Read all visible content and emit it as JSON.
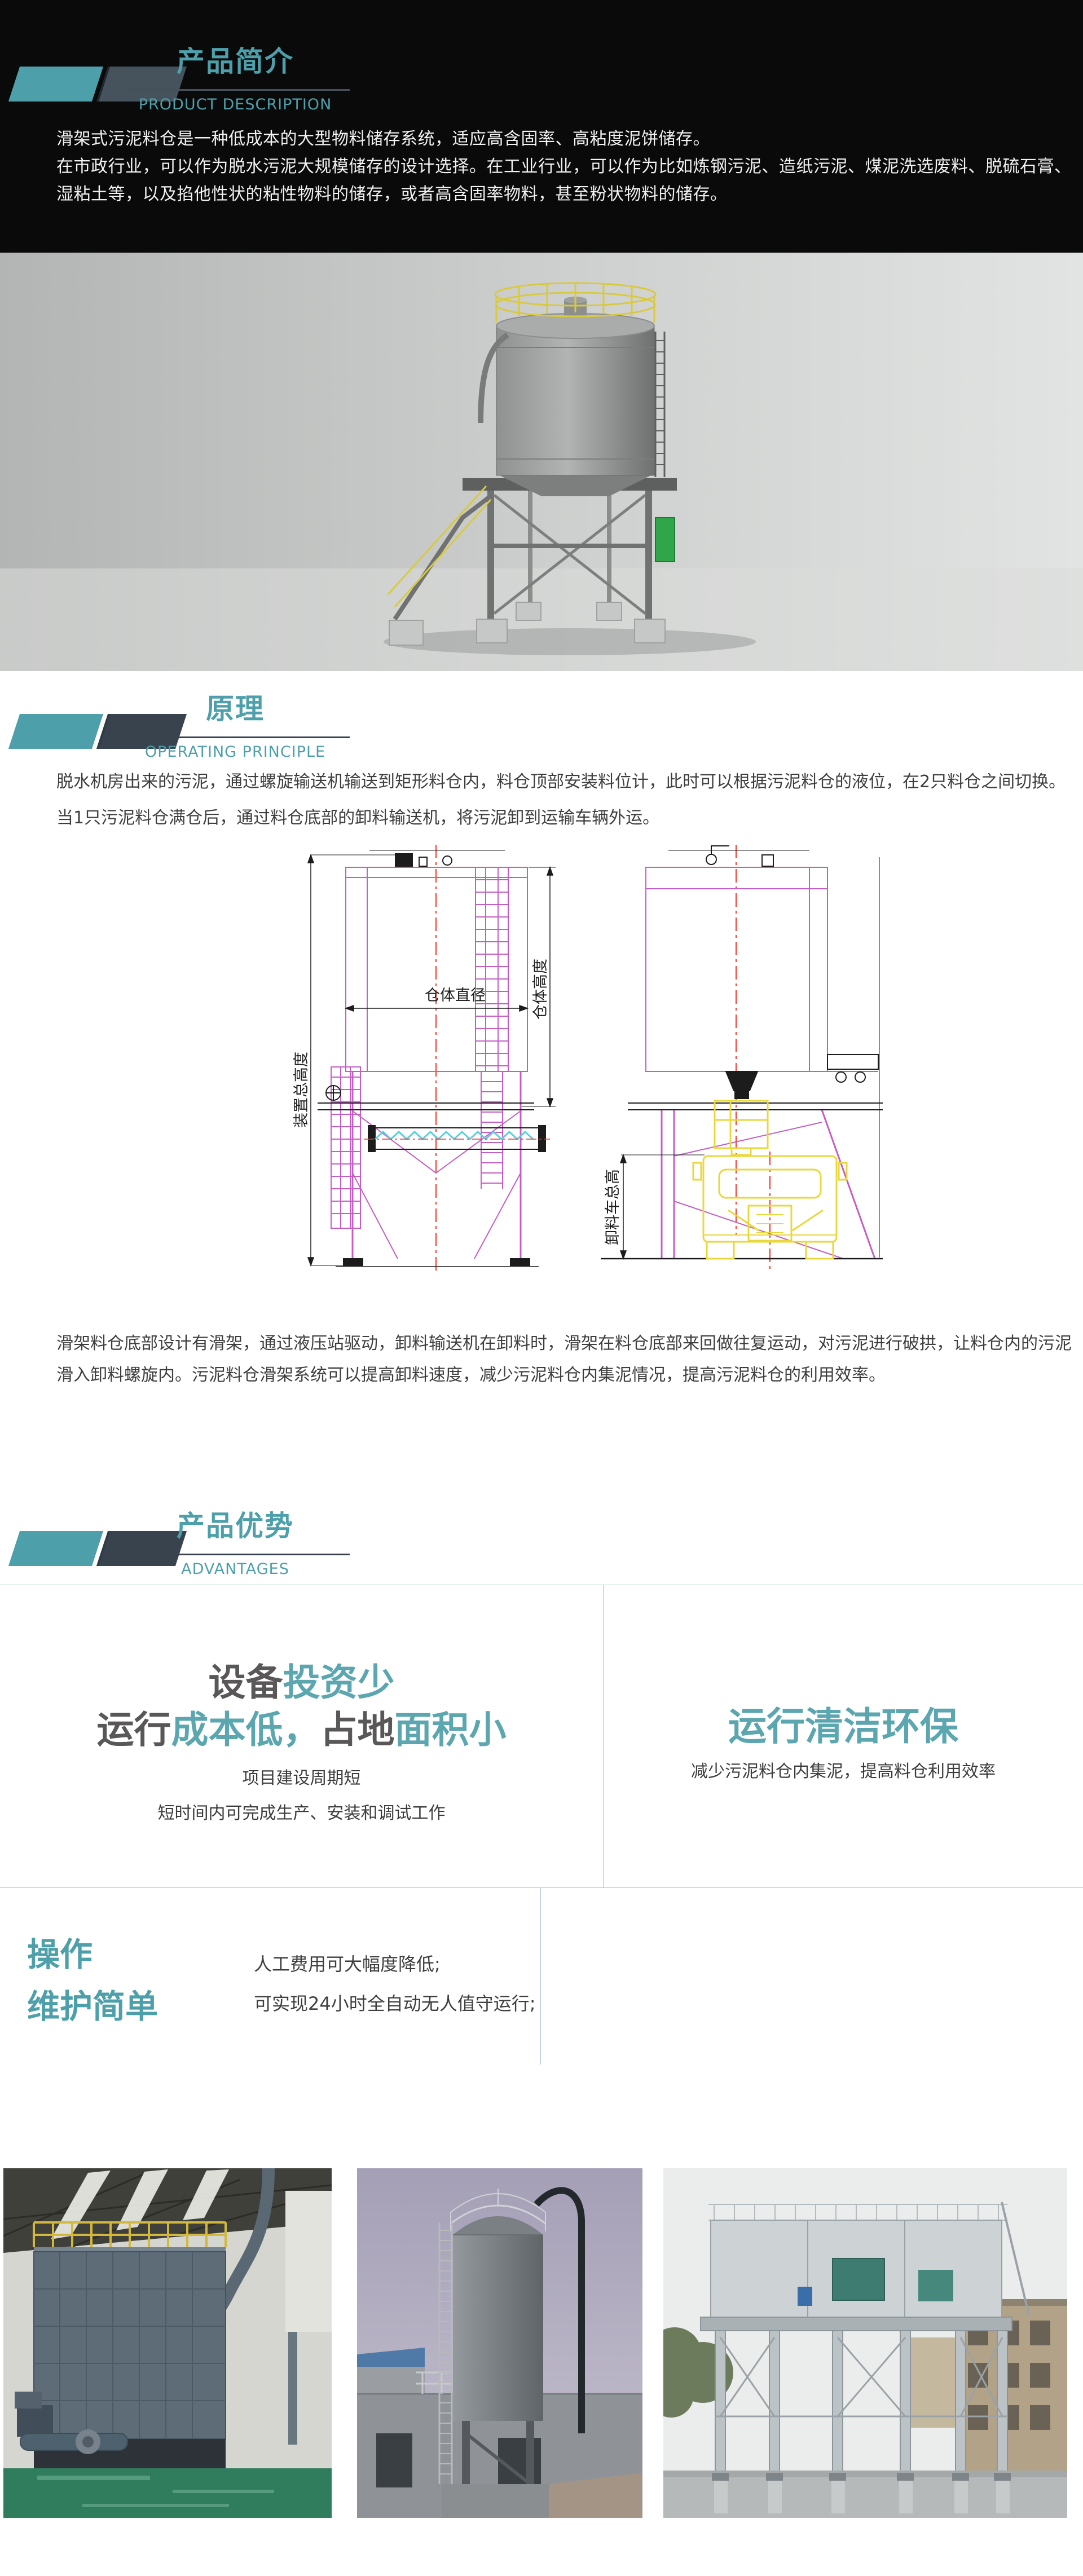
{
  "colors": {
    "accent_teal": "#4D9FA9",
    "headline_teal": "#5BA6AF",
    "headline_grey": "#595757",
    "divider_teal": "#A9C7CC",
    "intro_background": "#0A0A0A",
    "cad_magenta": "#C45EC4",
    "cad_centerline_red": "#E8392C",
    "cad_screw_cyan": "#58CFE0",
    "cad_truck_yellow": "#E8D83A"
  },
  "intro": {
    "title": "产品简介",
    "subtitle": "PRODUCT DESCRIPTION",
    "lines": [
      "滑架式污泥料仓是一种低成本的大型物料储存系统，适应高含固率、高粘度泥饼储存。",
      "在市政行业，可以作为脱水污泥大规模储存的设计选择。在工业行业，可以作为比如炼钢污泥、造纸污泥、煤泥洗选废料、脱硫石膏、",
      "湿粘土等，以及掐他性状的粘性物料的储存，或者高含固率物料，甚至粉状物料的储存。"
    ]
  },
  "principle": {
    "title": "原理",
    "subtitle": "OPERATING PRINCIPLE",
    "para1": [
      "脱水机房出来的污泥，通过螺旋输送机输送到矩形料仓内，料仓顶部安装料位计，此时可以根据污泥料仓的液位，在2只料仓之间切换。",
      "当1只污泥料仓满仓后，通过料仓底部的卸料输送机，将污泥卸到运输车辆外运。"
    ],
    "drawing": {
      "label_total_height": "装置总高度",
      "label_diameter": "仓体直径",
      "label_body_height": "仓体高度",
      "label_truck_height": "卸料车总高"
    },
    "para2": [
      "滑架料仓底部设计有滑架，通过液压站驱动，卸料输送机在卸料时，滑架在料仓底部来回做往复运动，对污泥进行破拱，让料仓内的污泥",
      "滑入卸料螺旋内。污泥料仓滑架系统可以提高卸料速度，减少污泥料仓内集泥情况，提高污泥料仓的利用效率。"
    ]
  },
  "advantages": {
    "title": "产品优势",
    "subtitle": "ADVANTAGES",
    "left": {
      "h1": [
        {
          "t": "设备",
          "c": "grey"
        },
        {
          "t": "投资少",
          "c": "teal"
        }
      ],
      "h2": [
        {
          "t": "运行",
          "c": "grey"
        },
        {
          "t": "成本低，",
          "c": "teal"
        },
        {
          "t": "占地",
          "c": "grey"
        },
        {
          "t": "面积小",
          "c": "teal"
        }
      ],
      "sub1": "项目建设周期短",
      "sub2": "短时间内可完成生产、安装和调试工作"
    },
    "right": {
      "headline": "运行清洁环保",
      "sub": "减少污泥料仓内集泥，提高料仓利用效率"
    }
  },
  "operation": {
    "title_line1": "操作",
    "title_line2": "维护简单",
    "points": [
      "人工费用可大幅度降低;",
      "可实现24小时全自动无人值守运行;"
    ]
  },
  "photos": {
    "photo1_name": "indoor-silo-installation-photo",
    "photo2_name": "outdoor-silo-tower-photo",
    "photo3_name": "steel-structure-silo-plant-photo"
  }
}
